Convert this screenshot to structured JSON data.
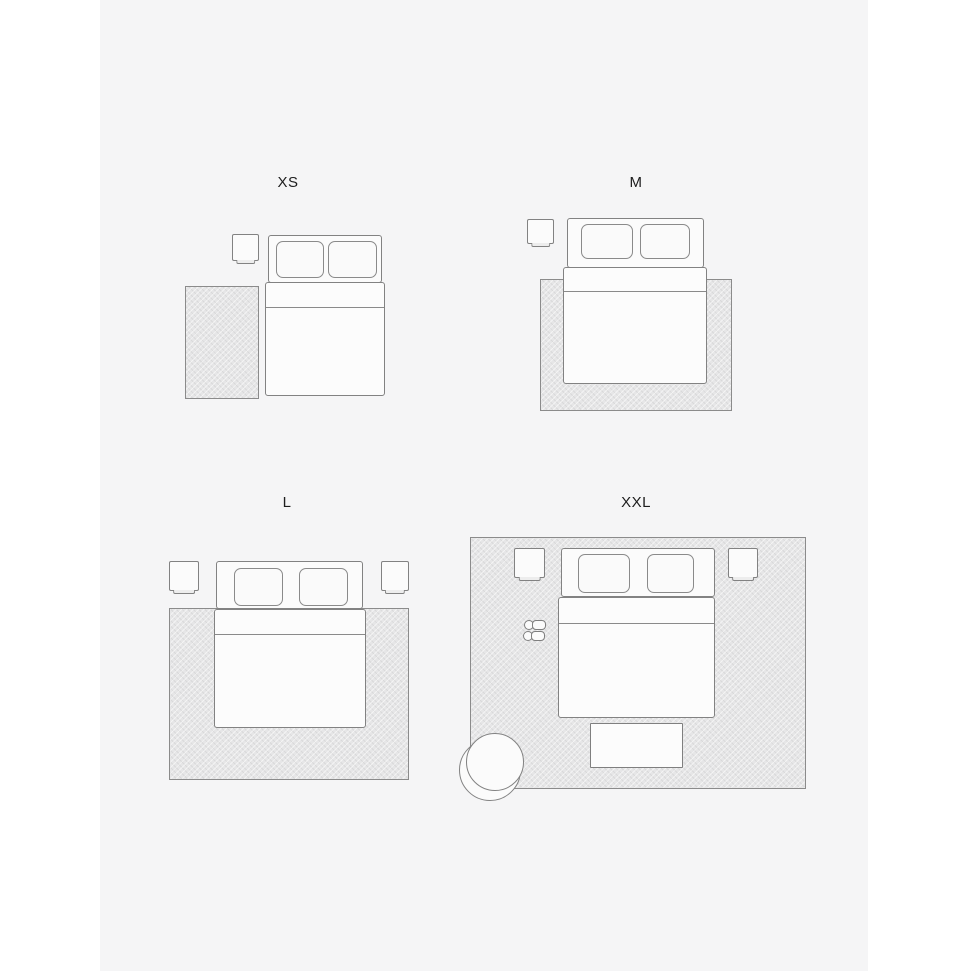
{
  "page": {
    "background_color": "#ffffff",
    "canvas_color": "#f5f5f6"
  },
  "colors": {
    "outline": "#828282",
    "rug_fill": "#e6e6e7",
    "rug_outline": "#8b8b8b",
    "furniture_fill": "#fbfbfb",
    "label_text": "#1d1d1d"
  },
  "panels": [
    {
      "id": "xs",
      "label": "XS",
      "items": [
        "rug",
        "nightstand",
        "double-bed"
      ]
    },
    {
      "id": "m",
      "label": "M",
      "items": [
        "rug",
        "nightstand",
        "double-bed"
      ]
    },
    {
      "id": "l",
      "label": "L",
      "items": [
        "rug",
        "nightstand-left",
        "nightstand-right",
        "double-bed"
      ]
    },
    {
      "id": "xxl",
      "label": "XXL",
      "items": [
        "rug",
        "nightstand-left",
        "nightstand-right",
        "double-bed",
        "slippers",
        "bench",
        "armchair"
      ]
    }
  ]
}
